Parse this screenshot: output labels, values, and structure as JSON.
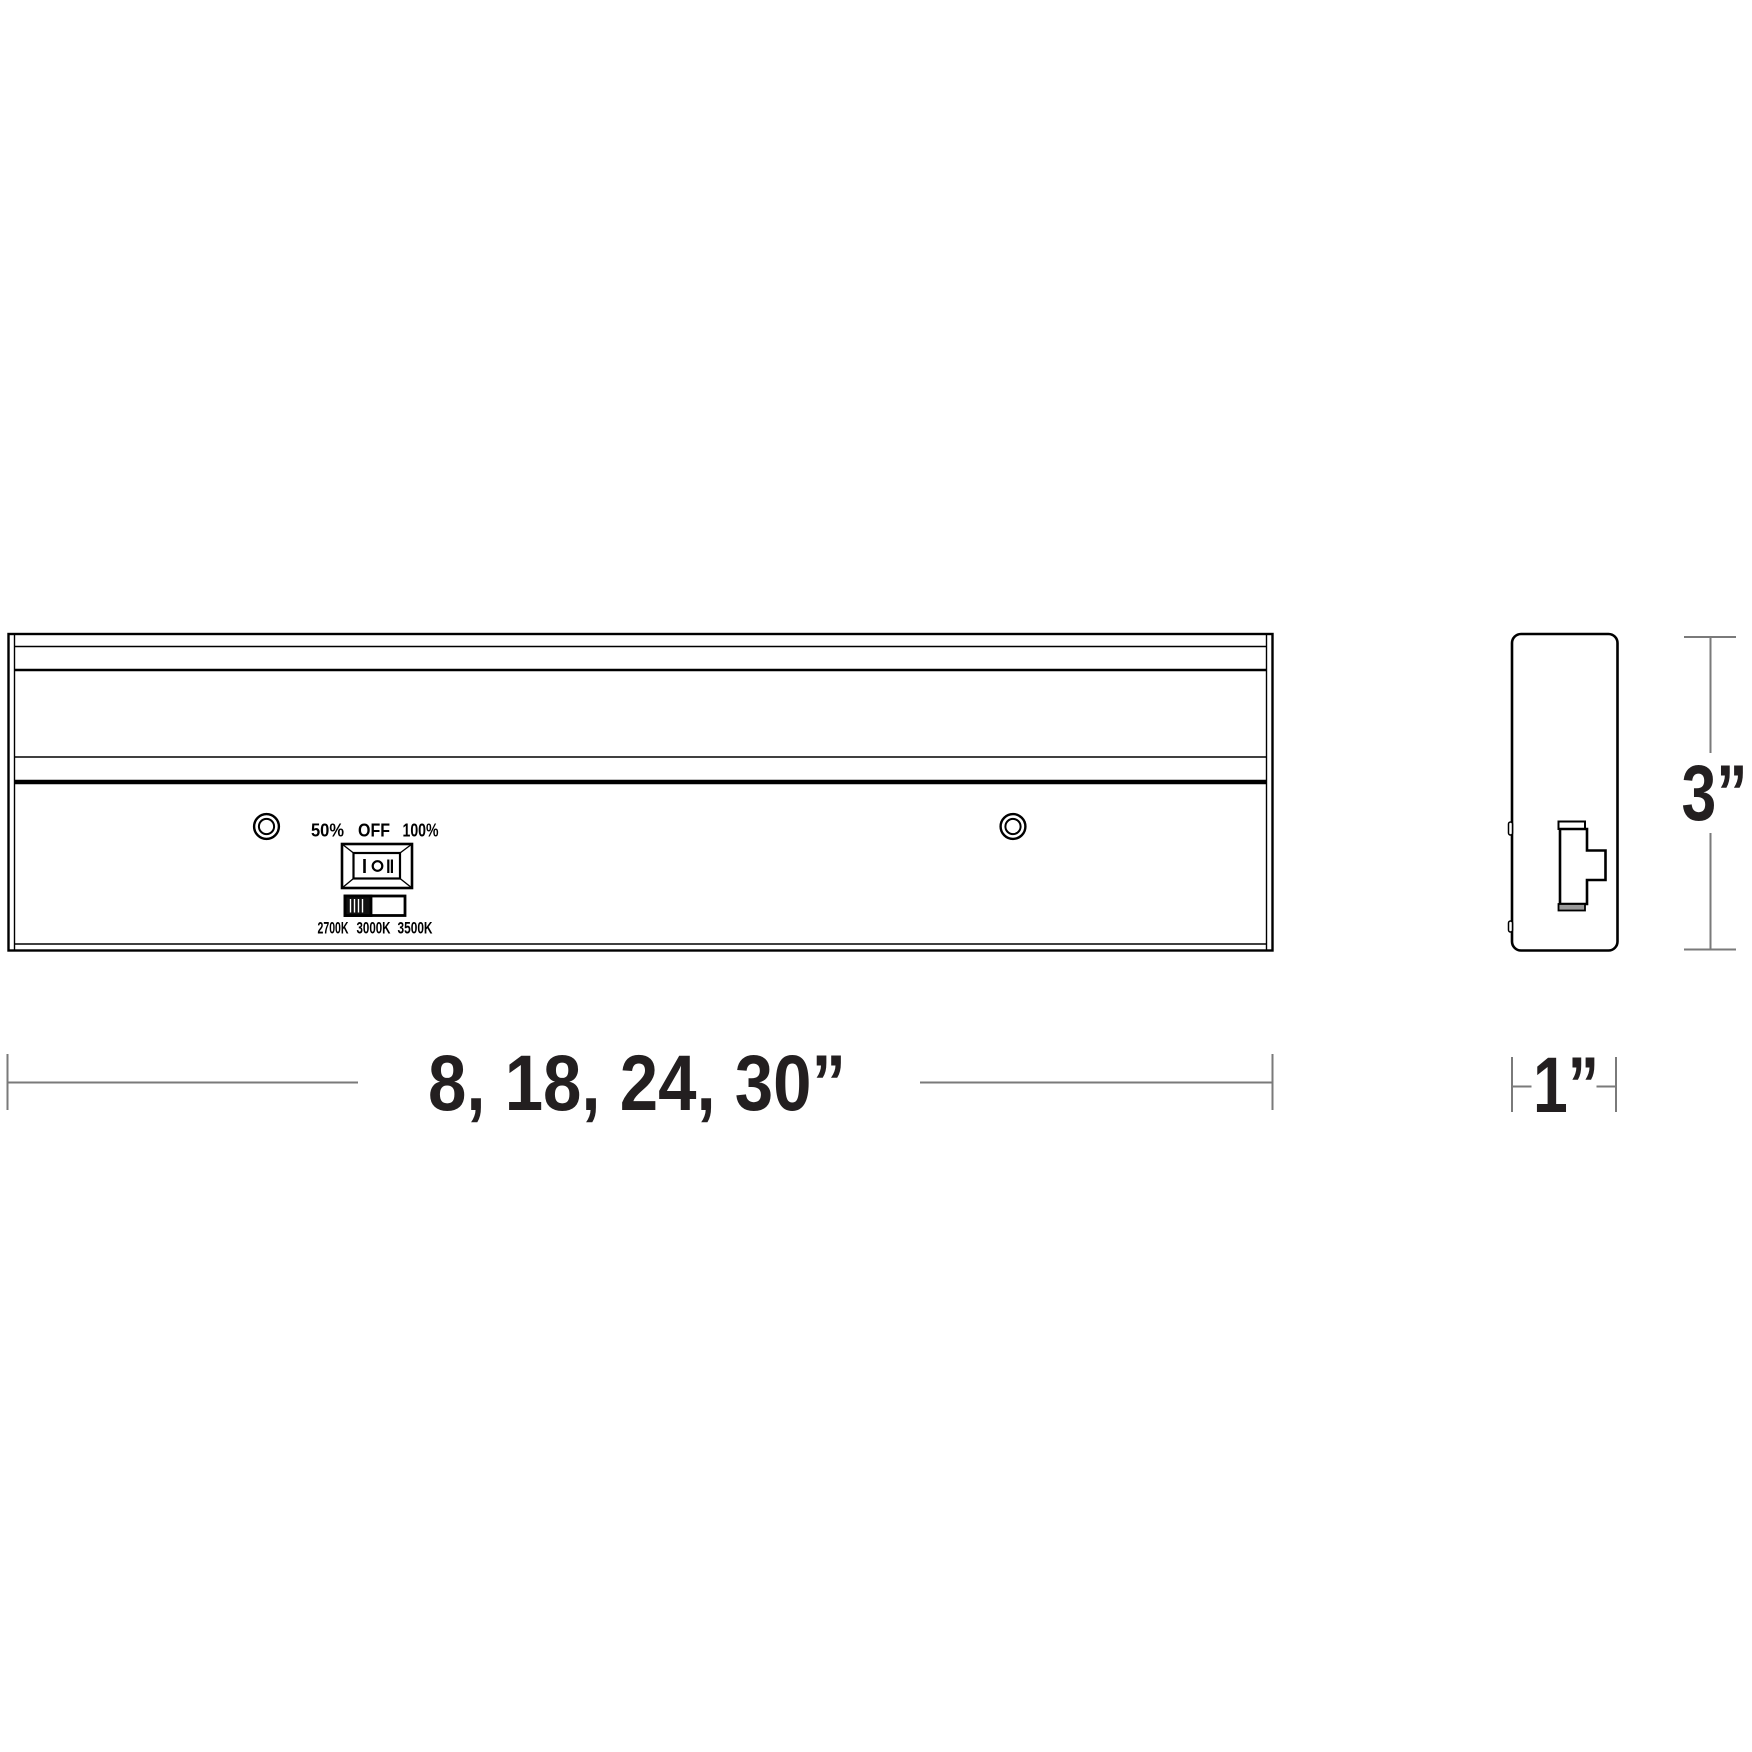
{
  "front_view": {
    "dimmer_labels": {
      "half": "50%",
      "off": "OFF",
      "full": "100%"
    },
    "cct_labels": {
      "k2700": "2700K",
      "k3000": "3000K",
      "k3500": "3500K"
    }
  },
  "dimensions": {
    "length": "8, 18, 24, 30”",
    "height": "3”",
    "depth": "1”"
  },
  "icons": {
    "screw_hole": "double-circle",
    "rocker_switch": "I-O-II rocker",
    "cct_slider": "3-position slide switch"
  },
  "colors": {
    "line": "#000000",
    "dimension_line": "#7a7a7a",
    "text": "#231f20",
    "background": "#ffffff",
    "slider_knob": "#111111",
    "switch_lip_fill": "#9a9a9a"
  }
}
